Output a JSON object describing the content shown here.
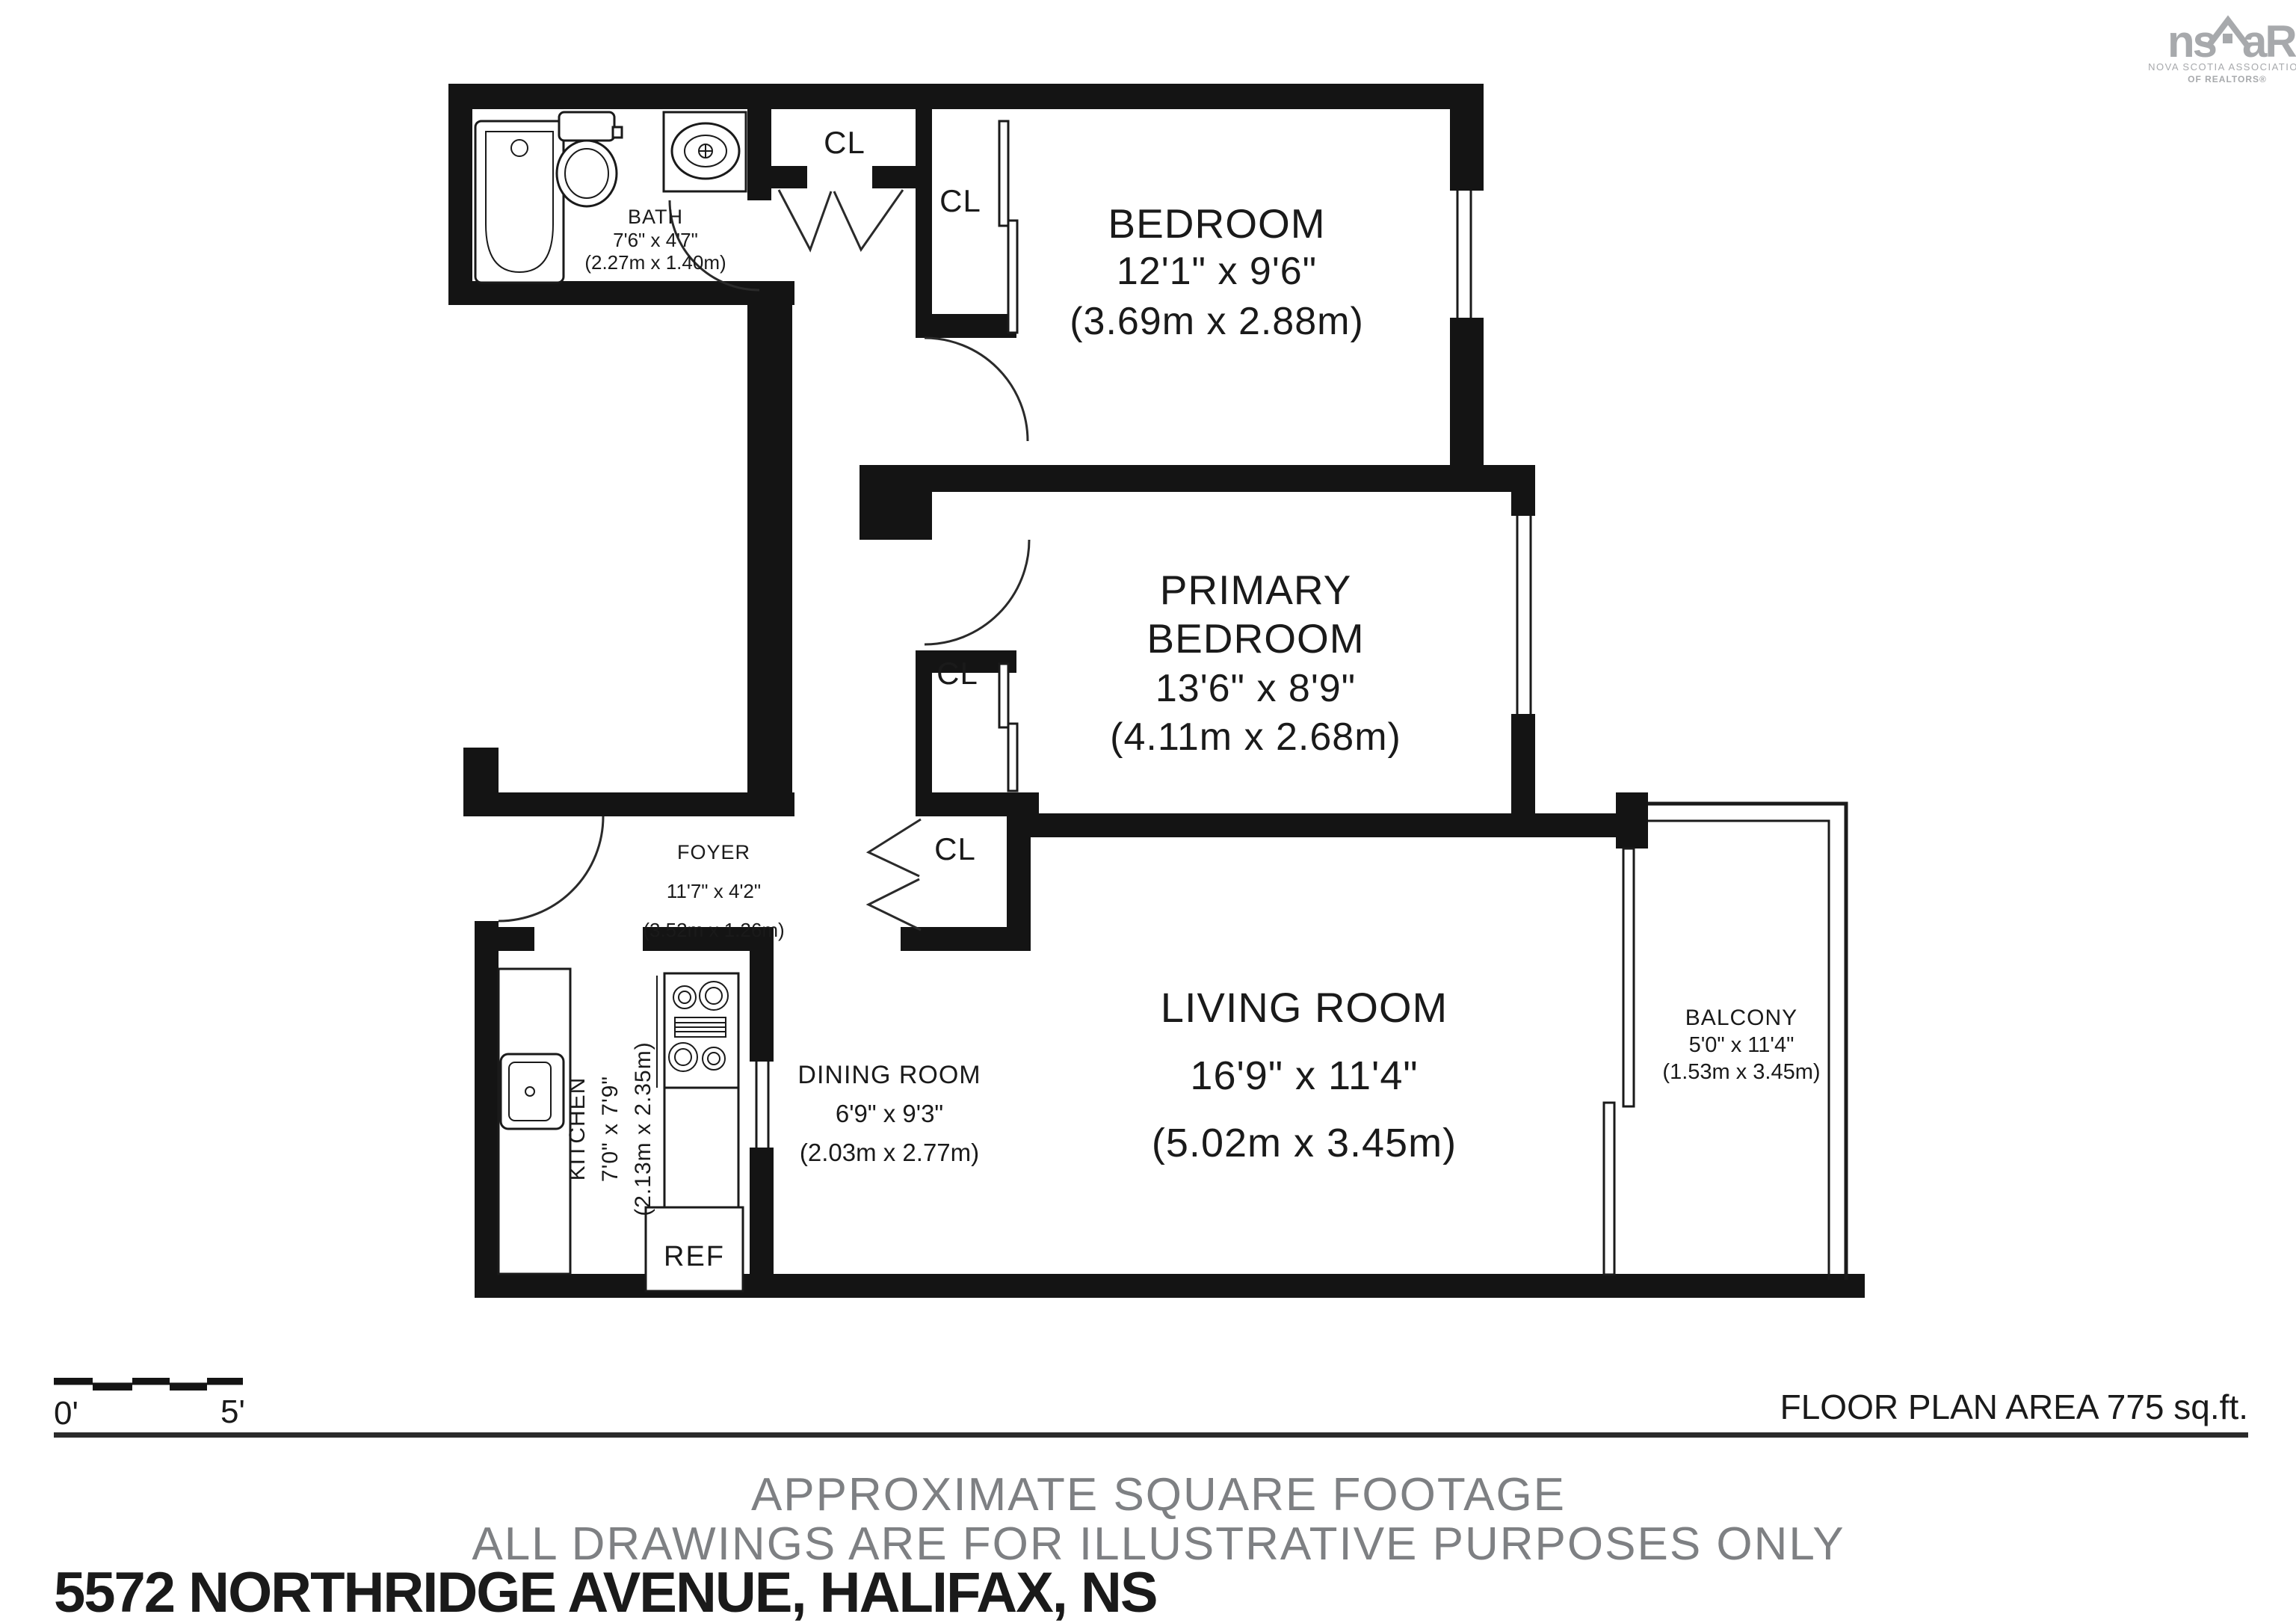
{
  "logo": {
    "ns": "ns",
    "ar": "aR",
    "caption1": "NOVA SCOTIA ASSOCIATION",
    "caption2": "OF REALTORS®"
  },
  "rooms": {
    "bath": {
      "name": "BATH",
      "imperial": "7'6\" x 4'7\"",
      "metric": "(2.27m x 1.40m)"
    },
    "bedroom": {
      "name": "BEDROOM",
      "imperial": "12'1\" x 9'6\"",
      "metric": "(3.69m x 2.88m)"
    },
    "primary": {
      "name1": "PRIMARY",
      "name2": "BEDROOM",
      "imperial": "13'6\" x 8'9\"",
      "metric": "(4.11m x 2.68m)"
    },
    "foyer": {
      "name": "FOYER",
      "imperial": "11'7\" x 4'2\"",
      "metric": "(3.52m x 1.26m)"
    },
    "kitchen": {
      "name": "KITCHEN",
      "imperial": "7'0\" x 7'9\"",
      "metric": "(2.13m x 2.35m)"
    },
    "dining": {
      "name": "DINING ROOM",
      "imperial": "6'9\" x 9'3\"",
      "metric": "(2.03m x 2.77m)"
    },
    "living": {
      "name": "LIVING ROOM",
      "imperial": "16'9\" x 11'4\"",
      "metric": "(5.02m x 3.45m)"
    },
    "balcony": {
      "name": "BALCONY",
      "imperial": "5'0\" x 11'4\"",
      "metric": "(1.53m x 3.45m)"
    }
  },
  "labels": {
    "closet": "CL",
    "fridge": "REF"
  },
  "scale_bar": {
    "start": "0'",
    "end": "5'"
  },
  "footer": {
    "area": "FLOOR PLAN AREA 775 sq.ft.",
    "note1": "APPROXIMATE SQUARE FOOTAGE",
    "note2": "ALL DRAWINGS ARE FOR ILLUSTRATIVE PURPOSES ONLY",
    "address": "5572 NORTHRIDGE AVENUE, HALIFAX, NS"
  },
  "colors": {
    "wall": "#141414",
    "logo_gray": "#a7a9ac",
    "note_gray": "#7e8083"
  }
}
